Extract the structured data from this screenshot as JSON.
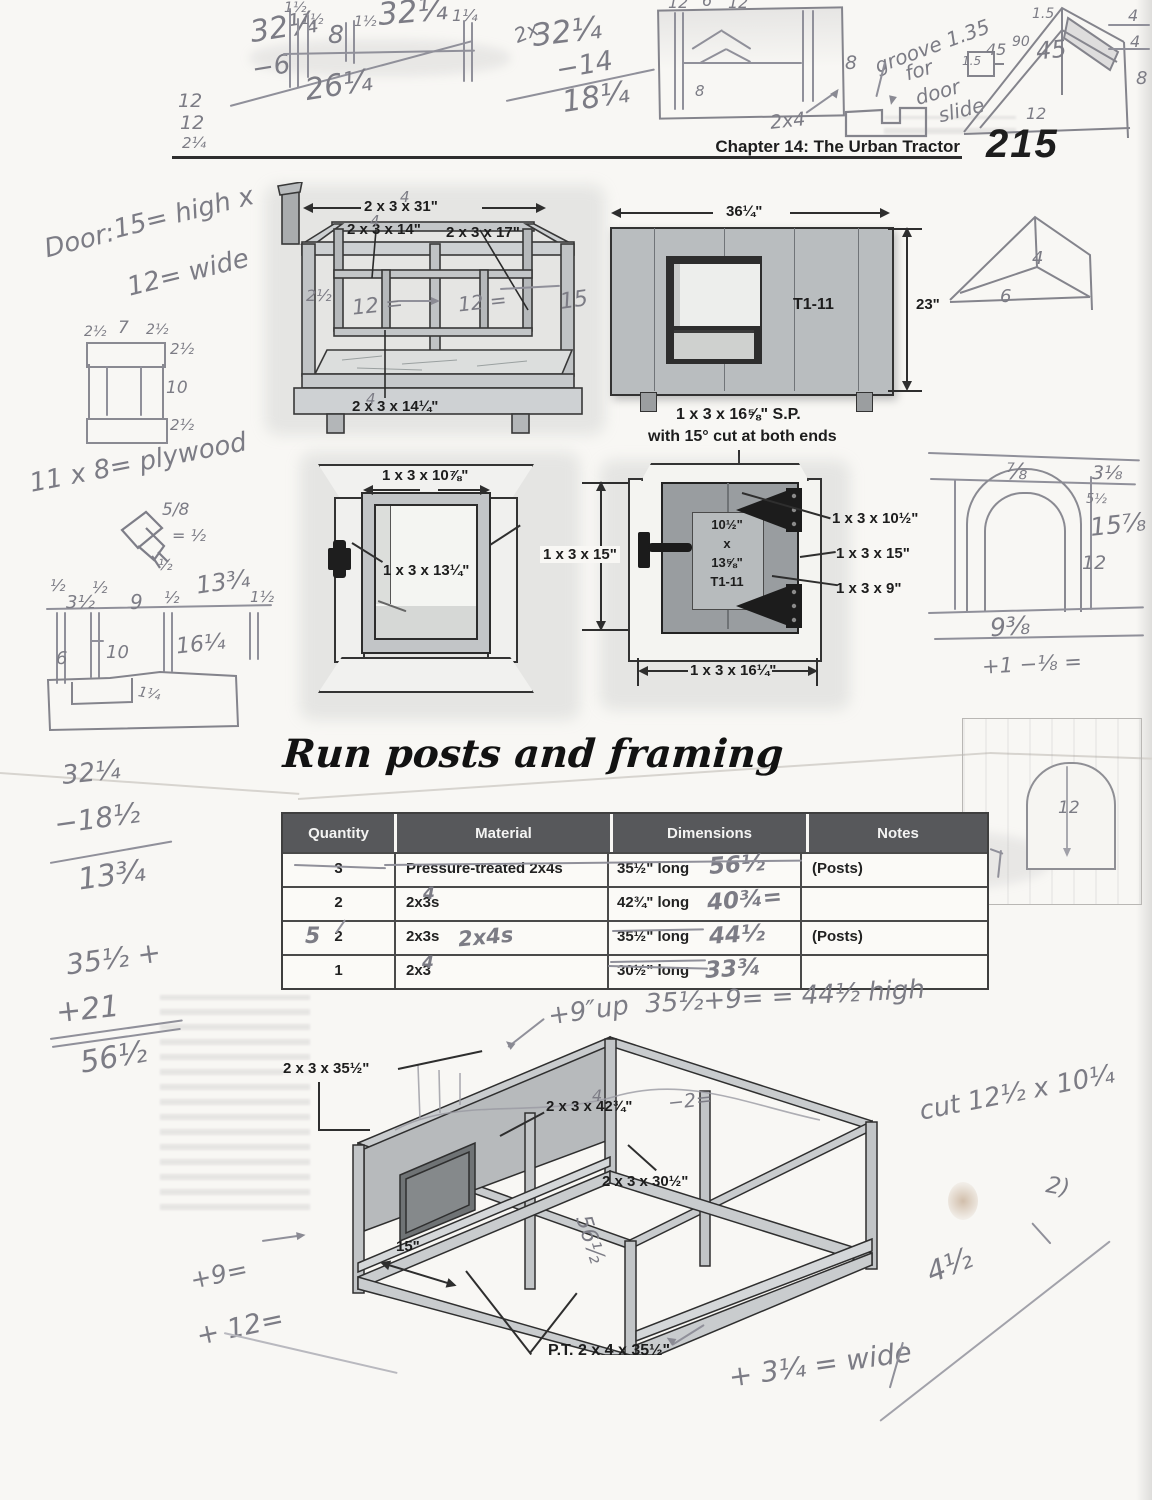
{
  "header": {
    "chapter": "Chapter 14: The Urban Tractor",
    "page_number": "215"
  },
  "section_heading": "Run posts and framing",
  "pencil_notes": {
    "top_left_calc": [
      "32¼",
      "−6",
      "26¼"
    ],
    "top_left_stack": [
      "12",
      "12",
      "2¼"
    ],
    "ruler_top": {
      "labels": [
        "1½",
        "1½",
        "8",
        "1½"
      ],
      "big": "32¼",
      "right": "1¼"
    },
    "top_center_calc": {
      "scribble": "2x",
      "lines": [
        "32¼",
        "−14",
        "18¼"
      ]
    },
    "window_sketch": {
      "top": [
        "12",
        "6",
        "12"
      ],
      "right": "8",
      "inner": "8",
      "caption": "2x4"
    },
    "groove_note": [
      "groove 1.35",
      "for",
      "door",
      "slide"
    ],
    "gable_sketch": {
      "ridge": "1.5",
      "left_box": "1.5",
      "angles": [
        "45",
        "90",
        "45"
      ],
      "right": [
        "4",
        "4",
        "8"
      ],
      "base": "12"
    },
    "door_note": [
      "Door:",
      "15= high x",
      "12= wide"
    ],
    "door_sketch": {
      "top": [
        "2½",
        "7",
        "2½"
      ],
      "right": [
        "2½",
        "10",
        "2½"
      ]
    },
    "plywood_note": "11 x 8= plywood",
    "hasp_sketch": [
      "5/8",
      "= ½",
      "½"
    ],
    "ruler_left": [
      "½",
      "3½",
      "½",
      "9",
      "½",
      "13¾",
      "1½"
    ],
    "board_sketch": [
      "6",
      "10",
      "16¼",
      "1¼"
    ],
    "arch_sketch": {
      "top": "⅞",
      "r1": "3⅛",
      "r2": "5½",
      "r3": "15⅞",
      "r4": "12",
      "base": "9⅜",
      "below": "+1 −⅛ ="
    },
    "triangle_sketch": [
      "4",
      "6"
    ],
    "arch_small": "12",
    "left_calc_mid": [
      "32¼",
      "−18½",
      "13¾"
    ],
    "left_calc_low": [
      "35½ +",
      "+21",
      "56½"
    ],
    "coop_hw": {
      "left": "2½",
      "mid1": "12 =",
      "mid2": "12 =",
      "right": "15",
      "four_a": "4",
      "four_b": "4",
      "four_c": "4"
    },
    "run_hw": {
      "up_note": "+9″up",
      "height_calc": "35½+9= = 44½ high",
      "post": "56½",
      "minus": "−2=",
      "four": "4"
    },
    "bottom_notes": {
      "cut": "cut 12½ x 10¼",
      "two": "2)",
      "four_half": "4½",
      "wide": "+ 3¼ = wide",
      "plus9": "+9=",
      "plus12": "+ 12="
    }
  },
  "diagrams": {
    "coop_frame": {
      "labels": [
        "2 x 3 x 31\"",
        "2 x 3 x 14\"",
        "2 x 3 x 17\"",
        "2 x 3 x 14¼\""
      ]
    },
    "side_panel": {
      "width": "36¼\"",
      "height": "23\"",
      "material": "T1-11",
      "caption1": "1 x 3 x 16⅝\" S.P.",
      "caption2": "with 15° cut at both ends"
    },
    "door_frame": {
      "top": "1 x 3 x 10⅞\"",
      "side": "1 x 3 x 13¼\""
    },
    "door": {
      "left": "1 x 3 x 15\"",
      "panel": [
        "10½\"",
        "x",
        "13⅝\"",
        "T1-11"
      ],
      "right": [
        "1 x 3 x 10½\"",
        "1 x 3 x 15\"",
        "1 x 3 x 9\""
      ],
      "bottom": "1 x 3 x 16¼\""
    },
    "run_frame": {
      "labels": [
        "2 x 3 x 35½\"",
        "2 x 3 x 42¾\"",
        "2 x 3 x 30½\"",
        "15\"",
        "P.T. 2 x 4 x 35½\""
      ]
    }
  },
  "table": {
    "columns": [
      "Quantity",
      "Material",
      "Dimensions",
      "Notes"
    ],
    "rows": [
      {
        "qty": "3",
        "mat": "Pressure-treated 2x4s",
        "dims": "35½\" long",
        "dims_hw": "56½",
        "notes": "(Posts)"
      },
      {
        "qty": "2",
        "mat": "2x3s",
        "mat_hw": "4",
        "dims": "42¾\" long",
        "dims_hw": "40¾=",
        "notes": ""
      },
      {
        "qty": "2",
        "qty_hw": "5",
        "mat": "2x3s",
        "mat_hw": "2x4s",
        "dims": "35½\" long",
        "dims_hw": "44½",
        "notes": "(Posts)"
      },
      {
        "qty": "1",
        "mat": "2x3",
        "mat_hw": "4",
        "dims": "30½\" long",
        "dims_hw": "33¾",
        "notes": ""
      }
    ]
  }
}
